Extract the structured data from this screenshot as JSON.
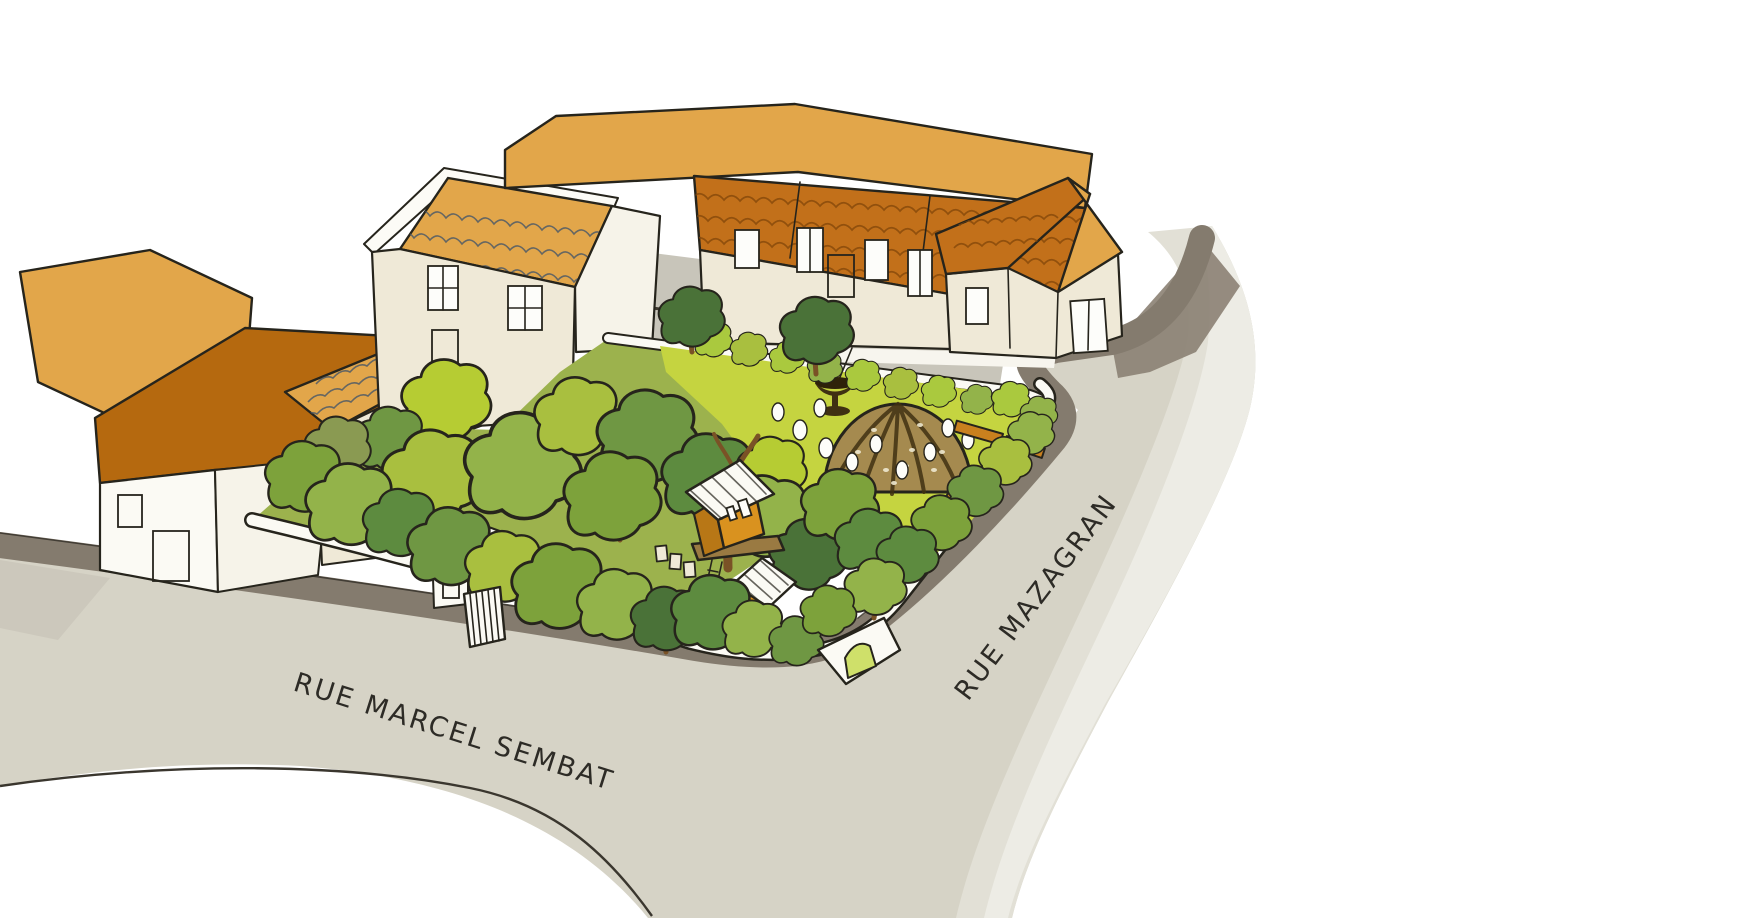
{
  "streets": {
    "marcel_sembat": {
      "label": "RUE MARCEL SEMBAT"
    },
    "mazagran": {
      "label": "RUE MAZAGRAN"
    }
  },
  "garden": {
    "features": [
      "tree-canopy",
      "lawn",
      "woven-dome",
      "fountain",
      "tree-house",
      "timber-hut",
      "garden-shed",
      "garden-gate",
      "arched-entrance",
      "benches",
      "stepping-stones"
    ]
  },
  "palette": {
    "background": "#ffffff",
    "street": "#d6d3c6",
    "street_wash_1": "#e2e0d6",
    "street_wash_2": "#edece5",
    "curb": "#847b6e",
    "shadow": "#8b8173",
    "alley": "#c8c5ba",
    "ink": "#26241c",
    "wall_white": "#fbfaf4",
    "cream": "#efe9d7",
    "cream_shade": "#f6f3e9",
    "roof_gold": "#e2a64a",
    "roof_orange": "#c2701a",
    "roof_rust": "#b5690f",
    "garden_base": "#9cb24d",
    "lawn": "#c5d440",
    "dome": "#a58a4f",
    "dome_dark": "#3f3012",
    "bench": "#c9801e",
    "trunk": "#7a5226",
    "arch_green": "#cfe06a",
    "stone": "#fdfdf9",
    "cabin_orange": "#d9921f",
    "cabin_shade": "#b87716",
    "greens": [
      "#7da23b",
      "#93b34a",
      "#a9bf3f",
      "#5d8b3f",
      "#4a7238",
      "#b6cc33",
      "#8a9a52",
      "#6f9743",
      "#aac93e",
      "#c2d45f"
    ]
  }
}
